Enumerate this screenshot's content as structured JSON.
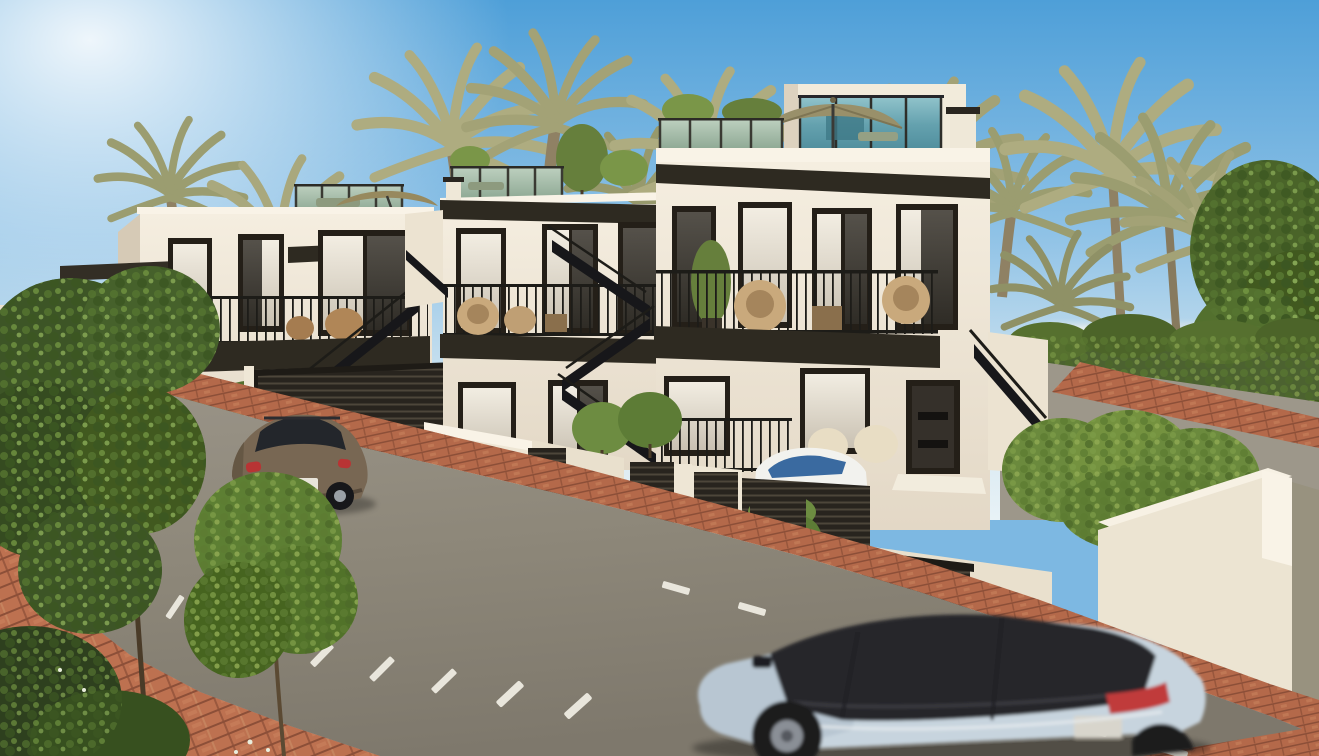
{
  "meta": {
    "kind": "photorealistic architectural render",
    "description": "Street-level view of a row of three modern white three-storey townhouses on a sloping street, with rooftop terraces, black external stairs, palm trees, brick sidewalks, a parked brown hatchback, a white car in a courtyard and a blurred light-blue SUV driving past in the foreground",
    "visible_text": "none (license plates illegible / motion blurred)"
  },
  "palette": {
    "sky_top": "#4e9fd8",
    "sky_mid": "#8fc2e6",
    "sky_horizon": "#e8f2f6",
    "sun_glare": "#ffffff",
    "wall_lit": "#f2ebdc",
    "wall_bright": "#f9f3e7",
    "wall_shadow": "#d9cebc",
    "fascia_dark": "#2e2a21",
    "railing_black": "#1d1c18",
    "glass_green": "#9db4a0",
    "glass_teal": "#64a1ae",
    "curtain_white": "#efeae0",
    "road_gray_far": "#9a9488",
    "road_gray_near": "#7e786c",
    "lane_marking": "#e9e6dc",
    "brick_red": "#b96f50",
    "brick_joint": "#8c4f38",
    "hedge_green": "#6b8a3d",
    "tree_dark_green": "#3d5526",
    "palm_khaki": "#a9a87d",
    "hill_olive": "#8d8f74",
    "umbrella_khaki": "#99906a",
    "beetle_brown": "#786753",
    "suv_body": "#c7d4de",
    "suv_roof": "#26262b",
    "taillight_red": "#c24040"
  },
  "scene": {
    "sky": "clear blue sky with sun glare at upper left",
    "vegetation": {
      "background_palms": "cluster of khaki date palms behind the rooflines",
      "right_palms": "three tall palms with visible trunks on the right",
      "right_tree": "dense dark green tree at right edge",
      "foreground_tree": "dark green tree at lower left foreground",
      "young_tree": "small leafy tree on the brick sidewalk, bottom centre-left",
      "hedges": "trimmed bright-green hedges over white boundary walls"
    },
    "buildings": {
      "count": 3,
      "style": "modern white render townhouses, 3 levels plus roof terrace",
      "features": "green-glass roof balustrades, khaki parasols, black metal balcony railings and zig-zag external stairs, dark louvred garage doors and gates, white stepped planter walls"
    },
    "street": {
      "surface": "gray asphalt curving from upper left to lower right",
      "markings": "white dashed centre line",
      "sidewalks": "red clay brick paving lower left, brick kerb strip along the houses, brick ramp upper right"
    },
    "vehicles": {
      "parked_car": "brown beetle-style hatchback parked on the road, rear view",
      "courtyard_car": "white compact car behind a dark louvred gate",
      "foreground_car": "light blue-grey SUV with black glass roof driving left, motion blurred"
    }
  }
}
